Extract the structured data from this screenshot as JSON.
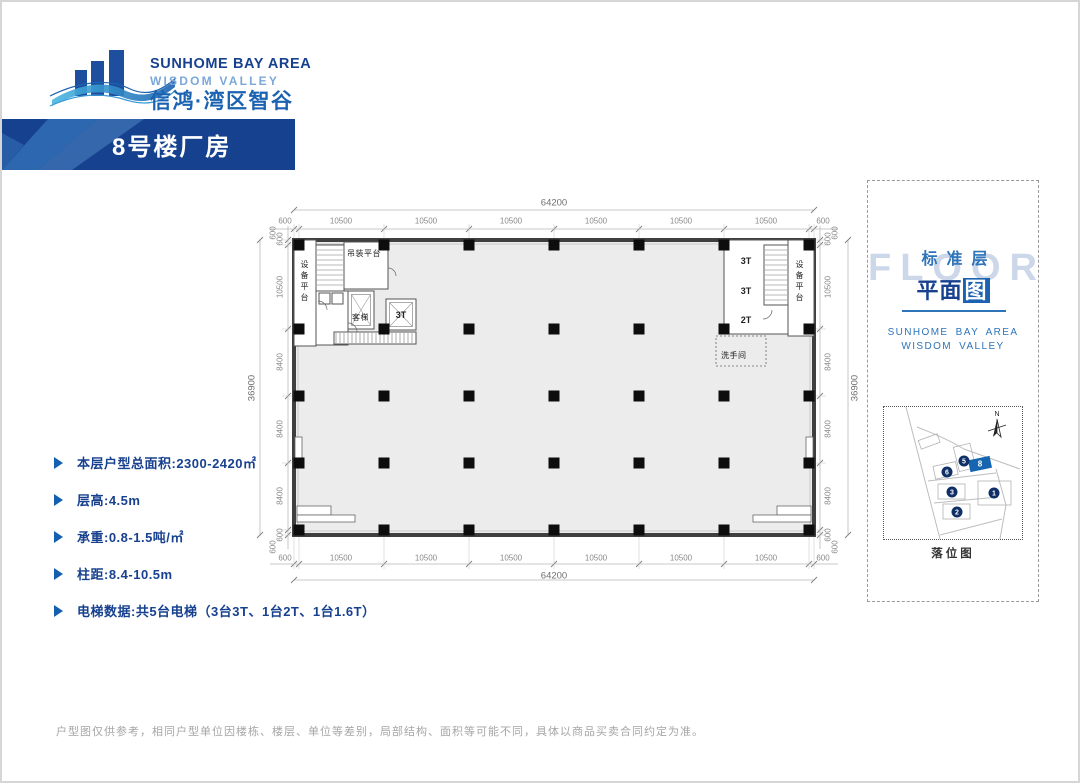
{
  "logo": {
    "brand_en": "SUNHOME BAY AREA",
    "brand_sub": "WISDOM VALLEY",
    "brand_cn": "信鸿·湾区智谷"
  },
  "banner": {
    "title": "8号楼厂房"
  },
  "specs": {
    "items": [
      "本层户型总面积:2300-2420㎡",
      "层高:4.5m",
      "承重:0.8-1.5吨/㎡",
      "柱距:8.4-10.5m",
      "电梯数据:共5台电梯（3台3T、1台2T、1台1.6T）"
    ]
  },
  "plan": {
    "dims": {
      "h_total": "64200",
      "v_total": "36900",
      "h_segments": [
        "600",
        "10500",
        "10500",
        "10500",
        "10500",
        "10500",
        "10500",
        "600"
      ],
      "v_segments": [
        "600",
        "10500",
        "8400",
        "8400",
        "8400",
        "600"
      ],
      "corner_offset": "600"
    },
    "rooms": {
      "equipment_platform_left": "设备平台",
      "hoisting_platform": "吊装平台",
      "passenger_elevator": "客梯",
      "elevator_3t_left": "3T",
      "elevator_right_1": "3T",
      "elevator_right_2": "3T",
      "elevator_right_3": "2T",
      "equipment_platform_right": "设备平台",
      "restroom": "洗手间"
    }
  },
  "side_panel": {
    "watermark": "FLOOR",
    "title_top": "标准层",
    "title_main_prefix": "平面",
    "title_main_suffix": "图",
    "brand_line1": "SUNHOME BAY AREA",
    "brand_line2": "WISDOM VALLEY",
    "north_label": "N",
    "map_caption": "落位图",
    "buildings": [
      {
        "label": "8",
        "highlight": true
      },
      {
        "label": "5",
        "highlight": false
      },
      {
        "label": "6",
        "highlight": false
      },
      {
        "label": "3",
        "highlight": false
      },
      {
        "label": "1",
        "highlight": false
      },
      {
        "label": "2",
        "highlight": false
      }
    ]
  },
  "footer": {
    "disclaimer": "户型图仅供参考，相同户型单位因楼栋、楼层、单位等差别，局部结构、面积等可能不同，具体以商品买卖合同约定为准。"
  },
  "colors": {
    "navy": "#17418f",
    "blue": "#1b62b1",
    "sky": "#7ba8d8",
    "watermark": "#ccd8ea",
    "dim_text": "#8a8a8a",
    "highlight_blue": "#1565b0"
  }
}
